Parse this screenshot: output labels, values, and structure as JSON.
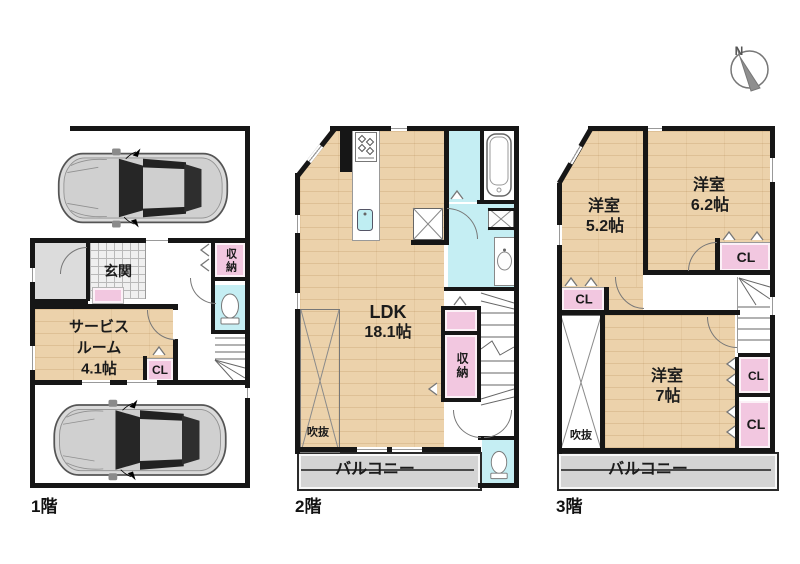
{
  "colors": {
    "wall": "#161616",
    "floor_wood": "#ecd2ab",
    "closet_pink": "#f2c7e0",
    "wet_area_cyan": "#c5eef3",
    "balcony_gray": "#d4d4d4",
    "porch_gray": "#dcdcdc"
  },
  "compass": {
    "north_label": "N"
  },
  "floor1": {
    "floor_label": "1階",
    "entrance_label": "玄関",
    "service_room_line1": "サービス",
    "service_room_line2": "ルーム",
    "service_room_size": "4.1帖",
    "closet_label": "CL",
    "storage_label": "収納"
  },
  "floor2": {
    "floor_label": "2階",
    "ldk_label": "LDK",
    "ldk_size": "18.1帖",
    "storage_label": "収納",
    "void_label": "吹抜",
    "balcony_label": "バルコニー"
  },
  "floor3": {
    "floor_label": "3階",
    "bedroom1_label": "洋室",
    "bedroom1_size": "5.2帖",
    "bedroom2_label": "洋室",
    "bedroom2_size": "6.2帖",
    "bedroom3_label": "洋室",
    "bedroom3_size": "7帖",
    "closet_top_label": "CL",
    "closet_left_label": "CL",
    "closet_mid_label": "CL",
    "closet_bottom_label": "CL",
    "void_label": "吹抜",
    "balcony_label": "バルコニー"
  }
}
